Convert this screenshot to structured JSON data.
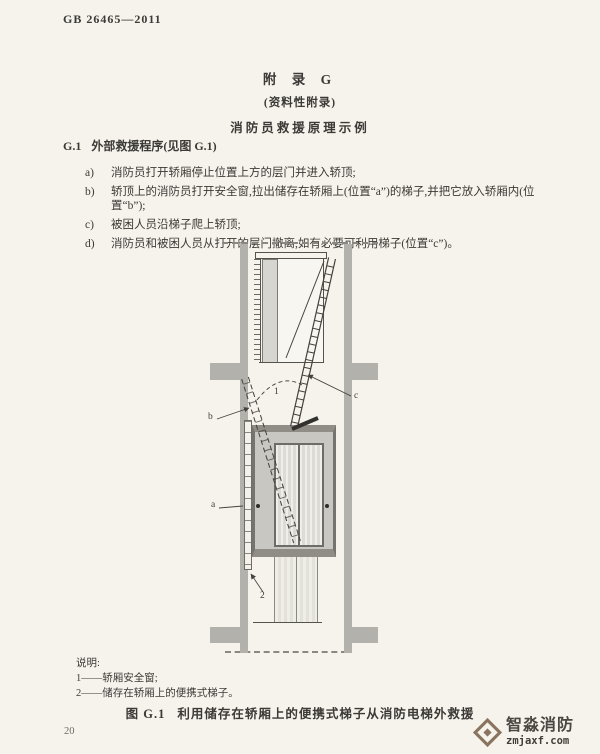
{
  "page": {
    "doc_number": "GB 26465—2011",
    "page_number": "20"
  },
  "appendix": {
    "title": "附 录 G",
    "subtitle": "(资料性附录)",
    "heading": "消防员救援原理示例"
  },
  "section": {
    "number": "G.1",
    "title": "外部救援程序(见图 G.1)"
  },
  "procedure": {
    "items": [
      {
        "marker": "a)",
        "text": "消防员打开轿厢停止位置上方的层门并进入轿顶;"
      },
      {
        "marker": "b)",
        "text": "轿顶上的消防员打开安全窗,拉出储存在轿厢上(位置“a”)的梯子,并把它放入轿厢内(位置“b”);"
      },
      {
        "marker": "c)",
        "text": "被困人员沿梯子爬上轿顶;"
      },
      {
        "marker": "d)",
        "text": "消防员和被困人员从打开的层门撤离,如有必要可利用梯子(位置“c”)。"
      }
    ]
  },
  "diagram": {
    "labels": {
      "safety_window": "1",
      "stored_ladder": "2",
      "pos_a": "a",
      "pos_b": "b",
      "pos_c": "c"
    }
  },
  "legend": {
    "title": "说明:",
    "entries": [
      "1——轿厢安全窗;",
      "2——储存在轿厢上的便携式梯子。"
    ]
  },
  "figure": {
    "label": "图 G.1",
    "title": "利用储存在轿厢上的便携式梯子从消防电梯外救援"
  },
  "watermark": {
    "name": "智淼消防",
    "url": "zmjaxf.com",
    "color": "#8a7460"
  }
}
